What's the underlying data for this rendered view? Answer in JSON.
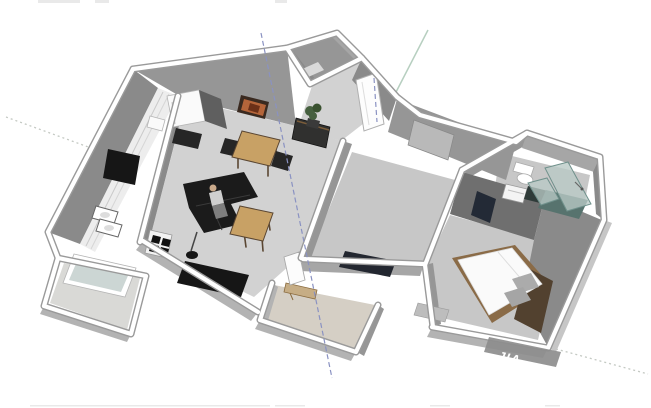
{
  "watermark": {
    "text": "JIA"
  },
  "colors": {
    "wall_top": "#ffffff",
    "wall_edge": "#9a9a9a",
    "wall_face": "#969696",
    "wall_face_light": "#a6a6a6",
    "wall_face_mid": "#8a8a8a",
    "wall_face_dark": "#6f6f6f",
    "wall_band": "#b3b3b3",
    "exterior_band": "#c6c6c6",
    "floor": "#d2d2d2",
    "floor_dim": "#c7c7c7",
    "floor_entry": "#d5cfc5",
    "floor_balcony": "#d9d9d6",
    "counter": "#ededed",
    "wood": "#c8a165",
    "wood_dark": "#5a4632",
    "wood_frame": "#8a6b47",
    "black": "#161616",
    "sofa": "#1b1b1b",
    "dark_rug": "#232730",
    "white_goods": "#fafafa",
    "glass": "#b9c9c5",
    "glass_edge": "#70918c",
    "glass_dark": "#57736e",
    "plant": "#46603f",
    "picture_frame": "#3a2a20",
    "picture_art": "#b5653a",
    "headboard": "#52412f",
    "pillow": "#ababab",
    "wardrobe": "#232a36",
    "person_shirt": "#cfcfcf",
    "person_legs": "#7e7e7e",
    "axis_blue": "#8a92c2",
    "axis_green": "#b7cfc0",
    "axis_dotted": "#c4c9c3",
    "watermark_bg": "#8d8d8d",
    "watermark_text": "#ffffff",
    "smudge": "#e9e9e9"
  },
  "scene": {
    "type": "3d-floorplan-cutaway-render",
    "rooms": [
      {
        "name": "kitchen",
        "objects": [
          "refrigerator",
          "kitchen-counter",
          "sink-basins",
          "microwave",
          "wall-tv"
        ]
      },
      {
        "name": "living-dining-room",
        "objects": [
          "wall-picture",
          "dining-table",
          "dining-chairs",
          "sofa",
          "seated-person",
          "coffee-table",
          "floor-lamp",
          "media-cabinet",
          "tv-rug"
        ]
      },
      {
        "name": "entry-vestibule",
        "objects": [
          "plant",
          "sideboard",
          "front-door-slab",
          "hall-door-slab"
        ]
      },
      {
        "name": "study-room",
        "objects": [
          "dark-rug",
          "window-panel"
        ]
      },
      {
        "name": "bathroom",
        "objects": [
          "toilet",
          "washing-machine",
          "glass-shower"
        ]
      },
      {
        "name": "bedroom",
        "objects": [
          "double-bed",
          "headboard",
          "pillows",
          "dark-wardrobe"
        ]
      },
      {
        "name": "lower-entry-room",
        "objects": [
          "wall-shelf",
          "door-panel"
        ]
      },
      {
        "name": "balcony",
        "objects": [
          "glass-window-panel"
        ]
      }
    ],
    "guides": [
      "blue-dashed-axis",
      "green-solid-axis",
      "dotted-guide-left",
      "dotted-guide-bottom-right",
      "short-vertical-dashed-guide"
    ]
  }
}
